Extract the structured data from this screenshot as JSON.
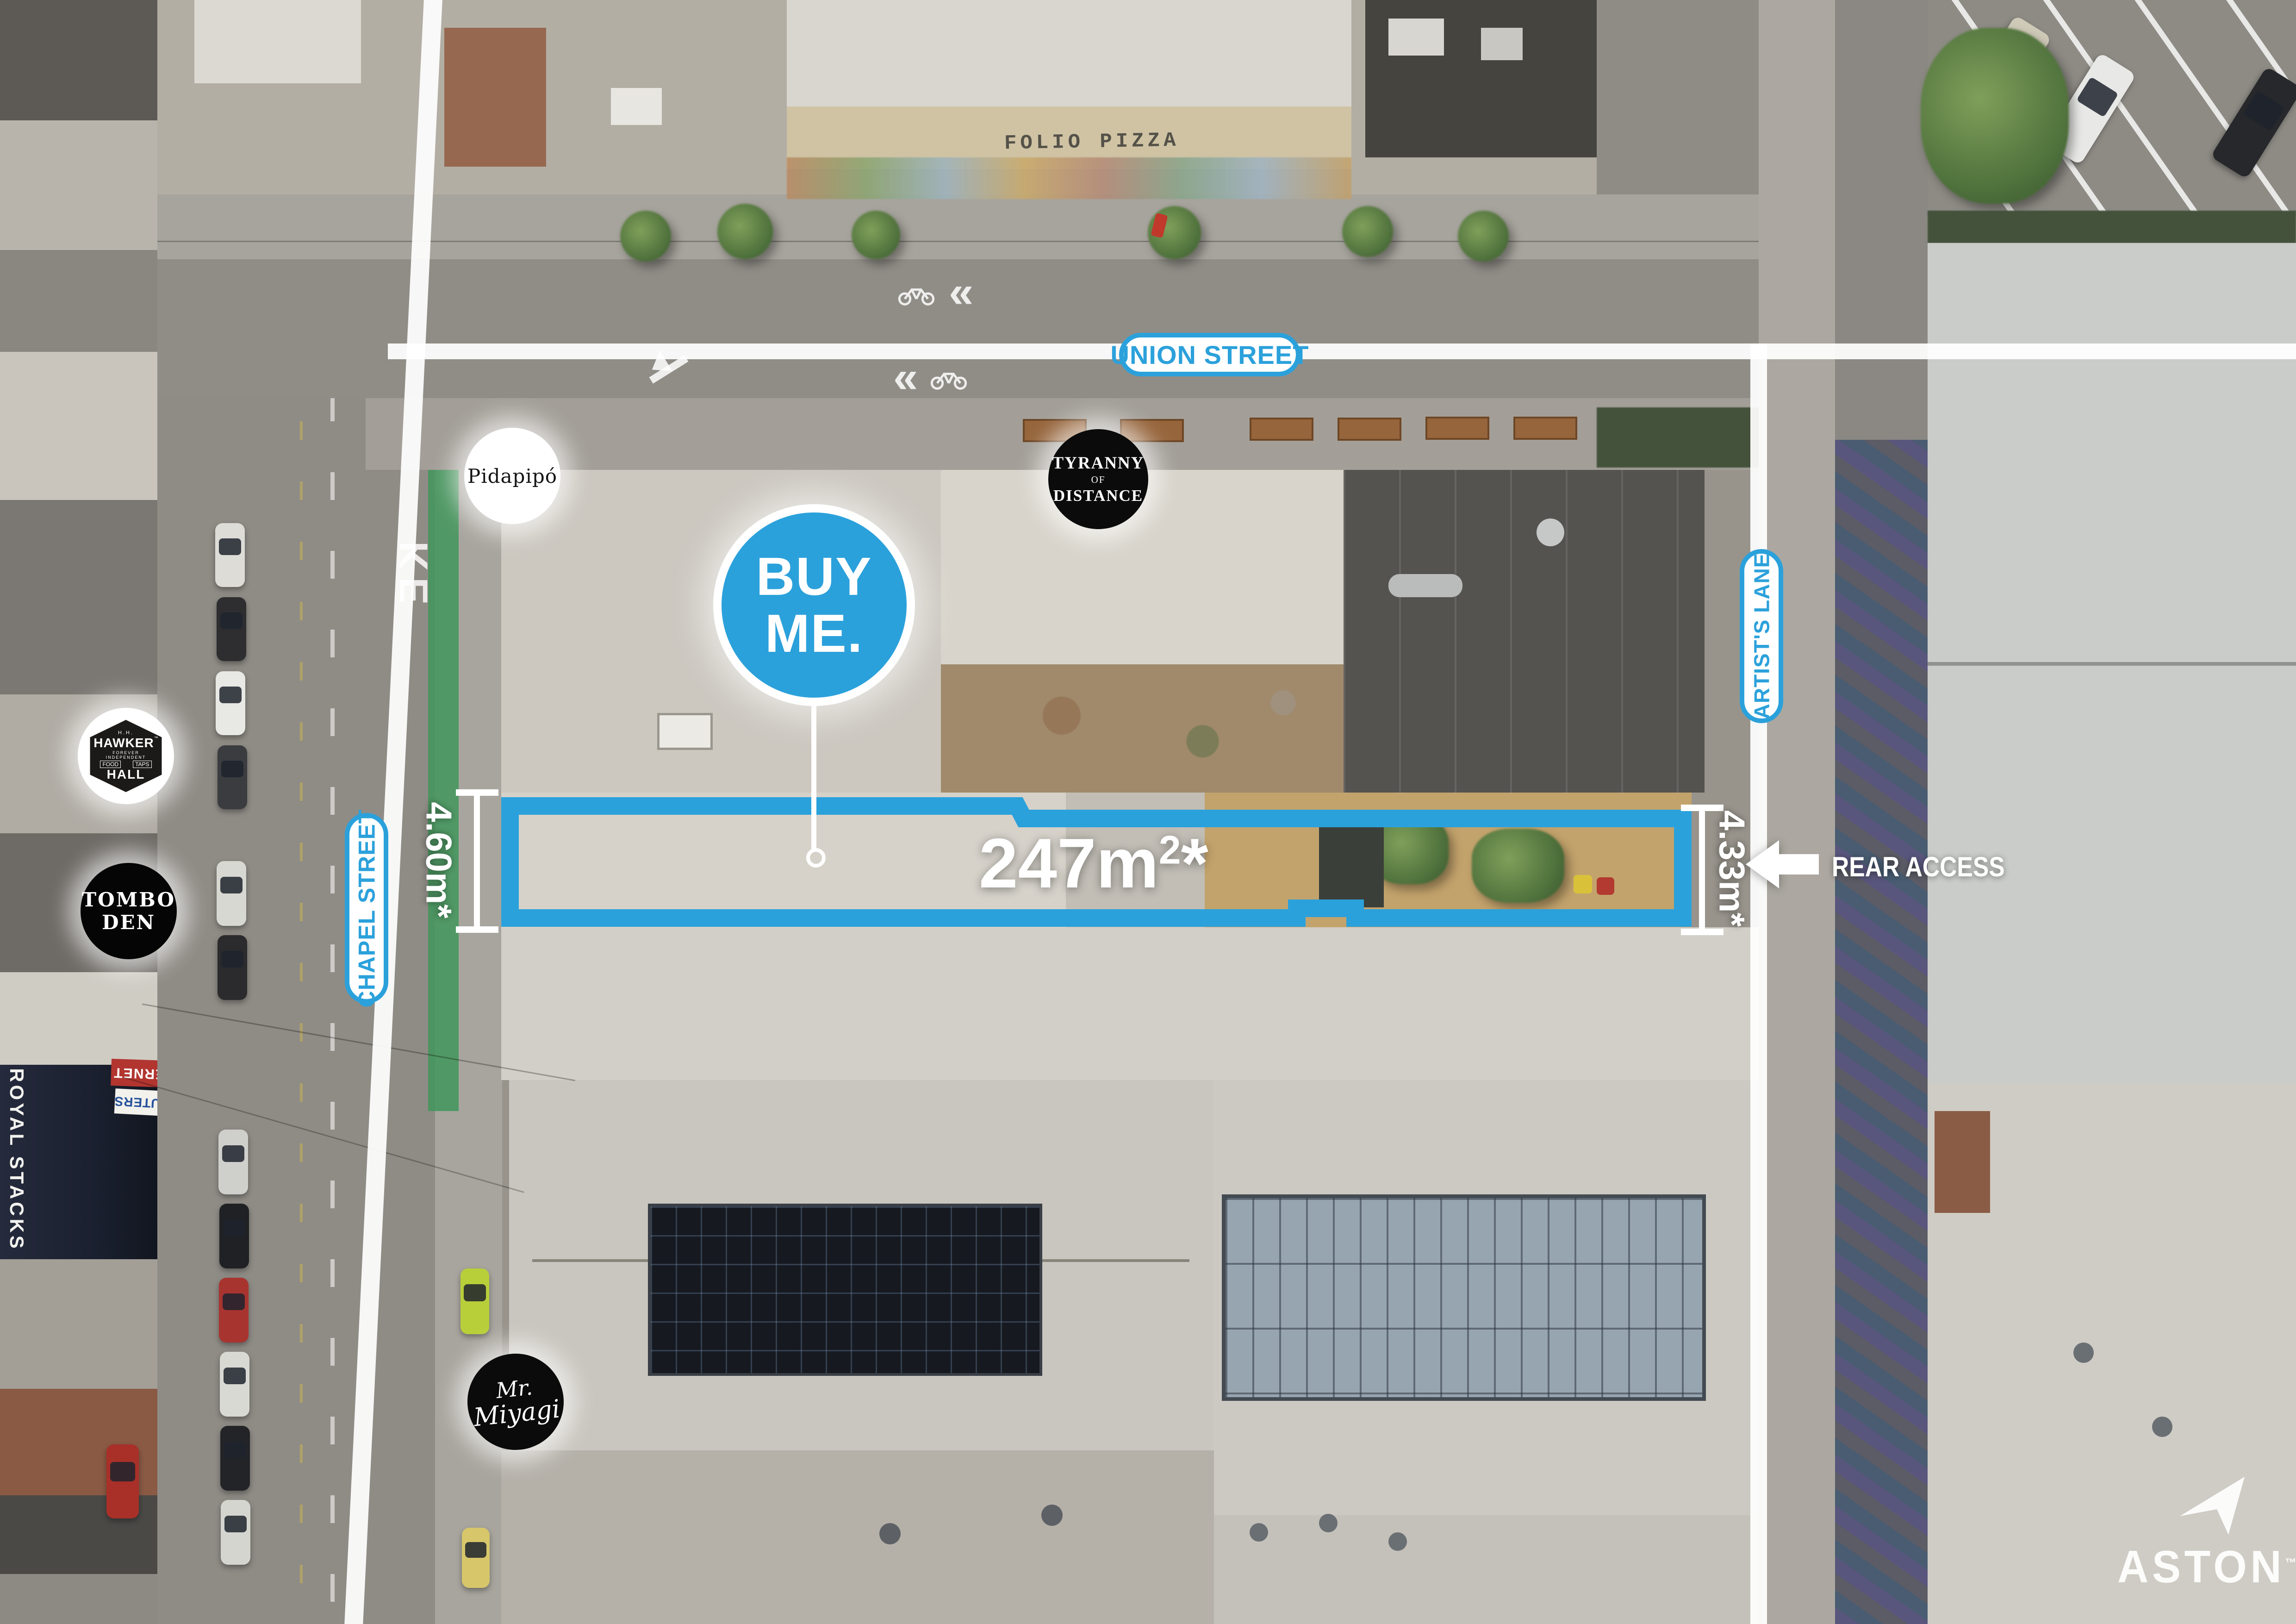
{
  "accent": {
    "blue": "#2BA1DB",
    "white": "#FFFFFF"
  },
  "streets": {
    "union": "UNION STREET",
    "chapel": "CHAPEL STREET",
    "artists_lane": "ARTIST'S LANE"
  },
  "property": {
    "badge_line1": "BUY",
    "badge_line2": "ME.",
    "area_value": "247m",
    "area_sup": "2",
    "area_star": "*",
    "width_left": "4.60m*",
    "width_right": "4.33m*",
    "rear_access": "REAR ACCESS"
  },
  "logos": {
    "pidapipo": "Pidapipó",
    "tyranny_of_distance": {
      "line1": "TYRANNY",
      "line2": "OF",
      "line3": "DISTANCE"
    },
    "hawker_hall": {
      "monogram": "H.H.",
      "name_top": "HAWKER",
      "tm": "™",
      "tagline1": "FOREVER",
      "tagline2": "INDEPENDENT",
      "tag_left": "FOOD",
      "tag_right": "TAPS",
      "name_bottom": "HALL"
    },
    "tombo_den": {
      "line1": "TOMBO",
      "line2": "DEN"
    },
    "mr_miyagi": {
      "line1": "Mr.",
      "line2": "Miyagi"
    }
  },
  "brand": {
    "name": "ASTON",
    "tm": "™"
  },
  "photo_text": {
    "graffiti_roof": "FOLIO PIZZA",
    "shop_awning": "ROYAL STACKS",
    "road_marking_top": "CLE",
    "road_marking_mid": "KE",
    "shop_sign_red": "INTERNET",
    "shop_sign_white": "COMPUTERS"
  }
}
